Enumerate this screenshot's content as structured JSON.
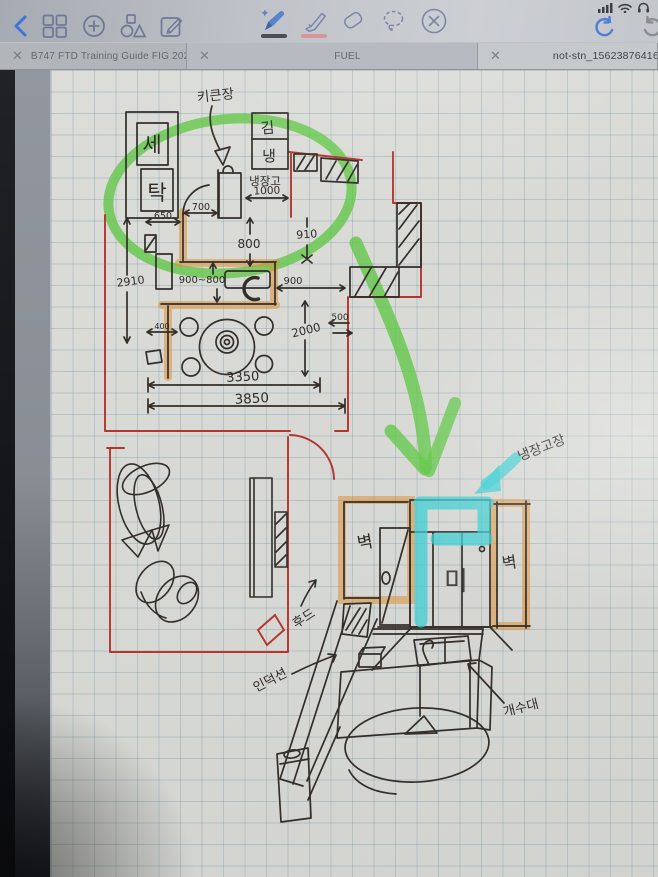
{
  "status_bar": {
    "icons": [
      "cellular-signal",
      "wifi",
      "headphones"
    ]
  },
  "toolbar": {
    "nav": [
      "back",
      "pages-grid",
      "add",
      "shapes",
      "compose"
    ],
    "tools": [
      {
        "id": "pen",
        "active": true,
        "swatch": "#4a4f56"
      },
      {
        "id": "highlighter",
        "active": false,
        "swatch": "#d9939a"
      },
      {
        "id": "eraser",
        "active": false
      },
      {
        "id": "lasso",
        "active": false
      },
      {
        "id": "no-drawing",
        "active": false
      }
    ],
    "history": [
      "undo",
      "redo"
    ]
  },
  "tabs": [
    {
      "label": "B747 FTD Training Guide FIG 20200717",
      "active": false
    },
    {
      "label": "FUEL",
      "active": false
    },
    {
      "label": "not-stn_156238764162",
      "active": true
    }
  ],
  "sketch": {
    "colors": {
      "ink": "#332e29",
      "red": "#b5342e",
      "orange": "#de944a",
      "green": "#5fc74b",
      "cyan": "#3ecdd3"
    },
    "plan": {
      "callout_tall_cabinet": "키큰장",
      "washer_top": "세",
      "washer_bottom": "탁",
      "kimchi_fridge_top": "김",
      "kimchi_fridge_bottom": "냉",
      "fridge": "냉장고",
      "dims": {
        "w1000": "1000",
        "w700": "700",
        "w650": "650",
        "h800": "800",
        "h910": "910",
        "h2910": "2910",
        "w900_800": "900~800",
        "w900": "900",
        "w400": "400",
        "h2000": "2000",
        "w500": "500",
        "w3350": "3350",
        "w3850": "3850"
      }
    },
    "elevation": {
      "callout_fridge_cabinet": "냉장고장",
      "wall": "벽",
      "door": "미",
      "hood": "후드",
      "induction": "인덕션",
      "sink": "개수대"
    }
  }
}
